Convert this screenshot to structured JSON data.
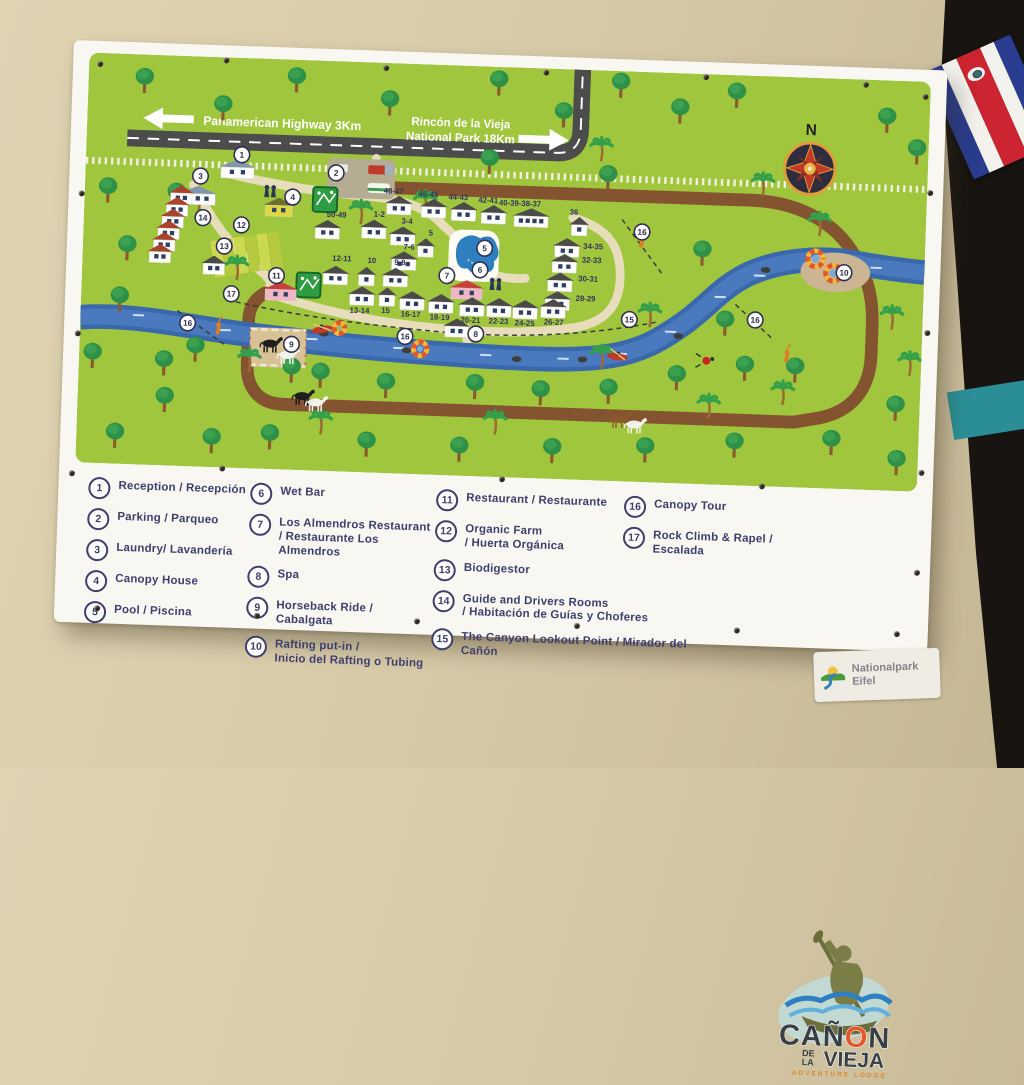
{
  "map": {
    "highway_label": "Panamerican Highway 3Km",
    "park_label_line1": "Rincón de la Vieja",
    "park_label_line2": "National Park 18Km",
    "compass_n": "N",
    "cabins": [
      {
        "label": "48-47",
        "x": 325,
        "y": 145,
        "ldx": -6,
        "ldy": -13
      },
      {
        "label": "46-45",
        "x": 361,
        "y": 147,
        "ldx": -6,
        "ldy": -13
      },
      {
        "label": "44-43",
        "x": 392,
        "y": 149,
        "ldx": -6,
        "ldy": -13
      },
      {
        "label": "42-41",
        "x": 423,
        "y": 151,
        "ldx": -6,
        "ldy": -13
      },
      {
        "label": "40-39-38-37",
        "x": 462,
        "y": 153,
        "ldx": -12,
        "ldy": -13
      },
      {
        "label": "36",
        "x": 512,
        "y": 160,
        "ldx": -6,
        "ldy": -13
      },
      {
        "label": "50-49",
        "x": 252,
        "y": 172,
        "ldx": 9,
        "ldy": -14
      },
      {
        "label": "1-2",
        "x": 300,
        "y": 170,
        "ldx": 5,
        "ldy": -14
      },
      {
        "label": "3-4",
        "x": 330,
        "y": 176,
        "ldx": 4,
        "ldy": -14
      },
      {
        "label": "5",
        "x": 354,
        "y": 187,
        "ldx": 5,
        "ldy": -14
      },
      {
        "label": "7-6",
        "x": 332,
        "y": 201,
        "ldx": 5,
        "ldy": -13
      },
      {
        "label": "12-11",
        "x": 262,
        "y": 218,
        "ldx": 6,
        "ldy": -16
      },
      {
        "label": "10",
        "x": 294,
        "y": 218,
        "ldx": 5,
        "ldy": -15
      },
      {
        "label": "9-8",
        "x": 324,
        "y": 218,
        "ldx": 4,
        "ldy": -14
      },
      {
        "label": "34-35",
        "x": 500,
        "y": 182,
        "ldx": 27,
        "ldy": -1
      },
      {
        "label": "32-33",
        "x": 498,
        "y": 198,
        "ldx": 28,
        "ldy": -3
      },
      {
        "label": "30-31",
        "x": 494,
        "y": 217,
        "ldx": 29,
        "ldy": -3
      },
      {
        "label": "28-29",
        "x": 492,
        "y": 236,
        "ldx": 29,
        "ldy": -2
      },
      {
        "label": "13-14",
        "x": 290,
        "y": 238,
        "ldx": -2,
        "ldy": 16
      },
      {
        "label": "15",
        "x": 316,
        "y": 238,
        "ldx": -1,
        "ldy": 15
      },
      {
        "label": "16-17",
        "x": 342,
        "y": 241,
        "ldx": -1,
        "ldy": 15
      },
      {
        "label": "18-19",
        "x": 372,
        "y": 243,
        "ldx": -1,
        "ldy": 15
      },
      {
        "label": "20-21",
        "x": 404,
        "y": 245,
        "ldx": -1,
        "ldy": 15
      },
      {
        "label": "22-23",
        "x": 432,
        "y": 245,
        "ldx": 0,
        "ldy": 15
      },
      {
        "label": "24-25",
        "x": 459,
        "y": 246,
        "ldx": 0,
        "ldy": 15
      },
      {
        "label": "26-27",
        "x": 488,
        "y": 244,
        "ldx": 1,
        "ldy": 15
      }
    ],
    "markers": [
      {
        "n": "1",
        "x": 161,
        "y": 98
      },
      {
        "n": "2",
        "x": 259,
        "y": 113
      },
      {
        "n": "3",
        "x": 119,
        "y": 121
      },
      {
        "n": "4",
        "x": 215,
        "y": 139
      },
      {
        "n": "5",
        "x": 415,
        "y": 184
      },
      {
        "n": "6",
        "x": 411,
        "y": 206
      },
      {
        "n": "7",
        "x": 377,
        "y": 213
      },
      {
        "n": "8",
        "x": 409,
        "y": 271
      },
      {
        "n": "9",
        "x": 219,
        "y": 288
      },
      {
        "n": "10",
        "x": 787,
        "y": 196
      },
      {
        "n": "11",
        "x": 201,
        "y": 219
      },
      {
        "n": "12",
        "x": 163,
        "y": 169
      },
      {
        "n": "13",
        "x": 146,
        "y": 191
      },
      {
        "n": "14",
        "x": 123,
        "y": 163
      },
      {
        "n": "15",
        "x": 567,
        "y": 251
      },
      {
        "n": "16",
        "x": 577,
        "y": 162
      },
      {
        "n": "16",
        "x": 697,
        "y": 247
      },
      {
        "n": "16",
        "x": 336,
        "y": 276
      },
      {
        "n": "16",
        "x": 111,
        "y": 270
      },
      {
        "n": "17",
        "x": 155,
        "y": 239
      }
    ]
  },
  "legend": {
    "columns": [
      {
        "items": [
          {
            "num": "1",
            "label": "Reception / Recepción"
          },
          {
            "num": "2",
            "label": "Parking / Parqueo"
          },
          {
            "num": "3",
            "label": "Laundry/ Lavandería"
          },
          {
            "num": "4",
            "label": "Canopy House"
          },
          {
            "num": "5",
            "label": "Pool / Piscina"
          }
        ]
      },
      {
        "items": [
          {
            "num": "6",
            "label": "Wet Bar"
          },
          {
            "num": "7",
            "label": "Los Almendros Restaurant\n/ Restaurante Los Almendros"
          },
          {
            "num": "8",
            "label": "Spa"
          },
          {
            "num": "9",
            "label": "Horseback Ride /\nCabalgata"
          },
          {
            "num": "10",
            "label": "Rafting put-in /\nInicio del Rafting o Tubing"
          }
        ]
      },
      {
        "items": [
          {
            "num": "11",
            "label": "Restaurant / Restaurante"
          },
          {
            "num": "12",
            "label": "Organic Farm\n/ Huerta Orgánica"
          },
          {
            "num": "13",
            "label": "Biodigestor"
          },
          {
            "num": "14",
            "label": "Guide and Drivers Rooms\n/ Habitación de Guías y Choferes"
          },
          {
            "num": "15",
            "label": "The Canyon Lookout Point / Mirador del Cañón"
          }
        ]
      },
      {
        "items": [
          {
            "num": "16",
            "label": "Canopy Tour"
          },
          {
            "num": "17",
            "label": "Rock Climb & Rapel /\nEscalada"
          }
        ]
      }
    ]
  },
  "logo": {
    "title": "CAÑON",
    "prefix_line1": "DE",
    "prefix_line2": "LA",
    "subtitle": "VIEJA",
    "tagline": "ADVENTURE LODGE"
  },
  "sticker": {
    "line1": "Nationalpark",
    "line2": "Eifel"
  },
  "colors": {
    "map_green": "#9fc63c",
    "river_blue": "#3a68ad",
    "dirt_road": "#84532f",
    "highway_gray": "#4c4c4c",
    "path_tan": "#e7ddba",
    "legend_navy": "#3f3f6e",
    "logo_orange": "#e2572b",
    "logo_olive": "#7a7d45"
  }
}
